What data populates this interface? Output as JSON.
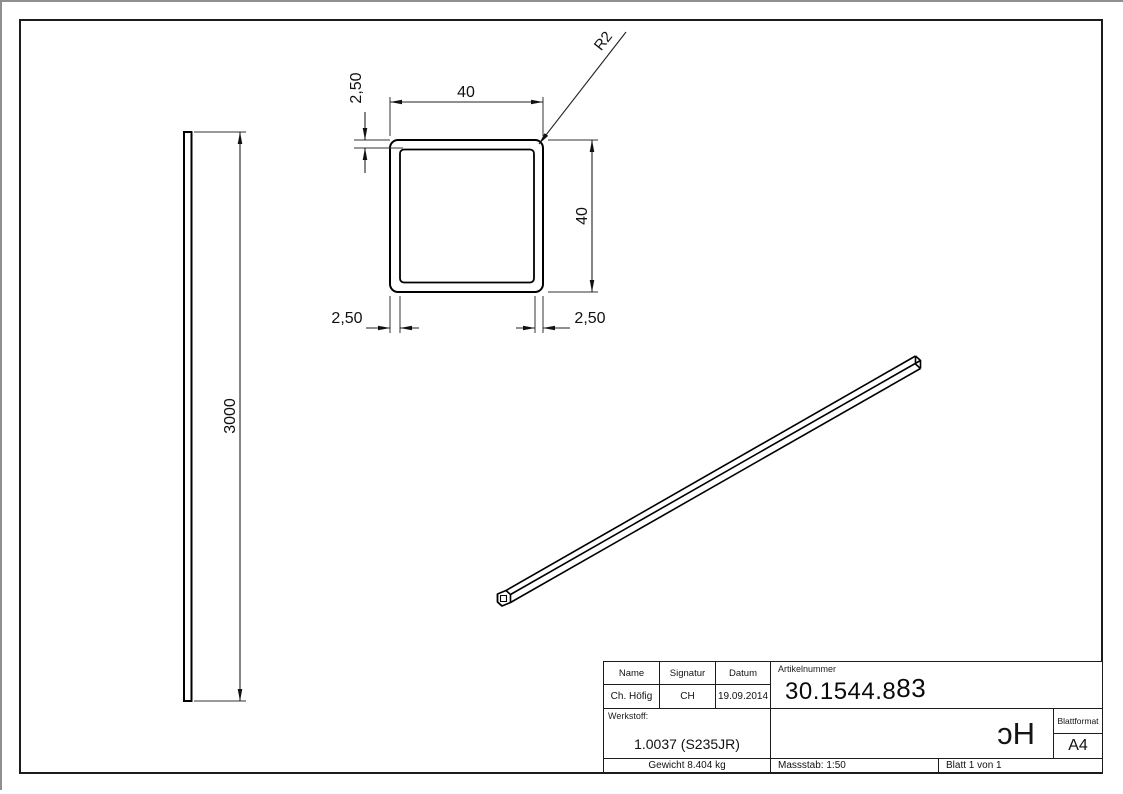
{
  "drawing": {
    "dimensions": {
      "length": "3000",
      "outer_width": "40",
      "outer_height": "40",
      "wall_thickness_top": "2,50",
      "wall_thickness_left": "2,50",
      "wall_thickness_right": "2,50",
      "corner_radius": "R2"
    },
    "title_block": {
      "headers": {
        "name": "Name",
        "signatur": "Signatur",
        "datum": "Datum",
        "artikelnummer": "Artikelnummer"
      },
      "values": {
        "name": "Ch. Höfig",
        "signatur": "CH",
        "datum": "19.09.2014",
        "artikelnummer_main": "30.1544.8",
        "artikelnummer_tail": "83"
      },
      "werkstoff_label": "Werkstoff:",
      "werkstoff_value": "1.0037 (S235JR)",
      "gewicht": "Gewicht 8.404 kg",
      "massstab": "Massstab: 1:50",
      "blatt": "Blatt 1 von 1",
      "blattformat_label": "Blattformat",
      "blattformat_value": "A4",
      "logo": "ɔH"
    }
  }
}
